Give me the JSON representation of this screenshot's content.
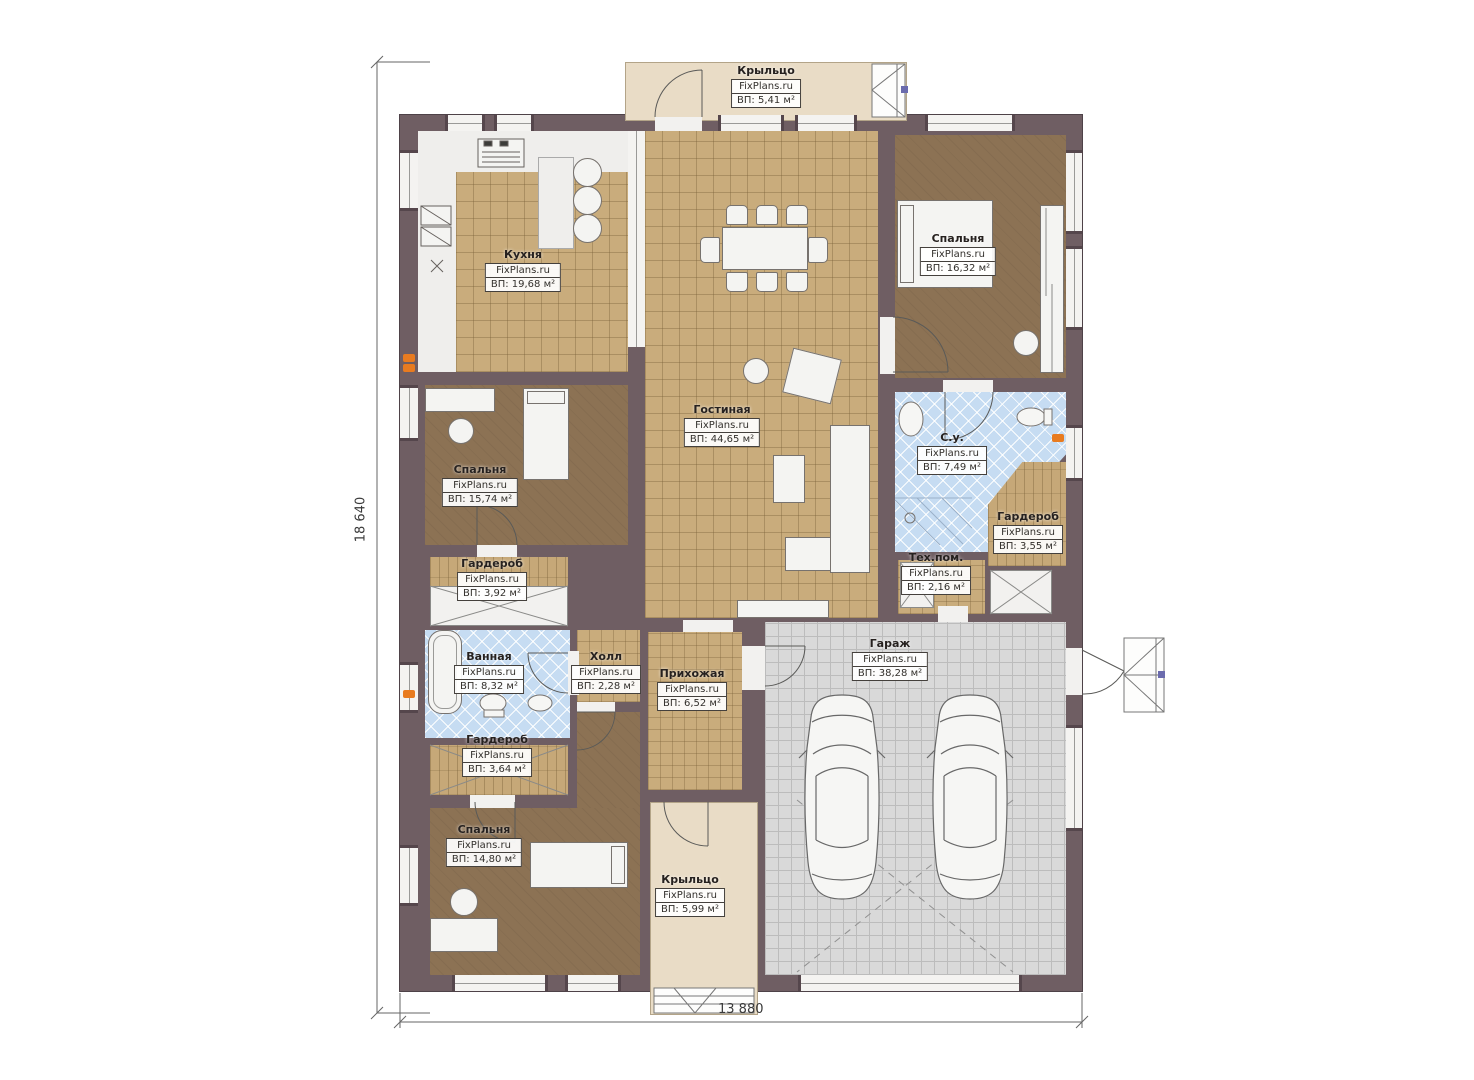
{
  "site_label": "FixPlans.ru",
  "dimensions": {
    "height": "18 640",
    "width": "13 880"
  },
  "rooms": [
    {
      "id": "porch-top",
      "name": "Крыльцо",
      "area": "ВП: 5,41 м²"
    },
    {
      "id": "kitchen",
      "name": "Кухня",
      "area": "ВП: 19,68 м²"
    },
    {
      "id": "bedroom-right",
      "name": "Спальня",
      "area": "ВП: 16,32 м²"
    },
    {
      "id": "living-room",
      "name": "Гостиная",
      "area": "ВП: 44,65 м²"
    },
    {
      "id": "bathroom-right",
      "name": "С.у.",
      "area": "ВП: 7,49 м²"
    },
    {
      "id": "wardrobe-right",
      "name": "Гардероб",
      "area": "ВП: 3,55 м²"
    },
    {
      "id": "bedroom-left",
      "name": "Спальня",
      "area": "ВП: 15,74 м²"
    },
    {
      "id": "wardrobe-left-upper",
      "name": "Гардероб",
      "area": "ВП: 3,92 м²"
    },
    {
      "id": "tech-room",
      "name": "Тех.пом.",
      "area": "ВП: 2,16 м²"
    },
    {
      "id": "bathroom-left",
      "name": "Ванная",
      "area": "ВП: 8,32 м²"
    },
    {
      "id": "hall",
      "name": "Холл",
      "area": "ВП: 2,28 м²"
    },
    {
      "id": "entry-hall",
      "name": "Прихожая",
      "area": "ВП: 6,52 м²"
    },
    {
      "id": "garage",
      "name": "Гараж",
      "area": "ВП: 38,28 м²"
    },
    {
      "id": "wardrobe-left-lower",
      "name": "Гардероб",
      "area": "ВП: 3,64 м²"
    },
    {
      "id": "bedroom-bottom",
      "name": "Спальня",
      "area": "ВП: 14,80 м²"
    },
    {
      "id": "porch-bottom",
      "name": "Крыльцо",
      "area": "ВП: 5,99 м²"
    }
  ],
  "colors": {
    "wall": "#6f5e63",
    "tile_tan": "#c9ac7c",
    "floor_brown": "#8c7254",
    "tile_blue": "#c6dcf2",
    "garage_gray": "#d9d9d9",
    "porch_beige": "#e9dcc6",
    "outlet_orange": "#e87b20",
    "marker_blue": "#6b6bad"
  }
}
